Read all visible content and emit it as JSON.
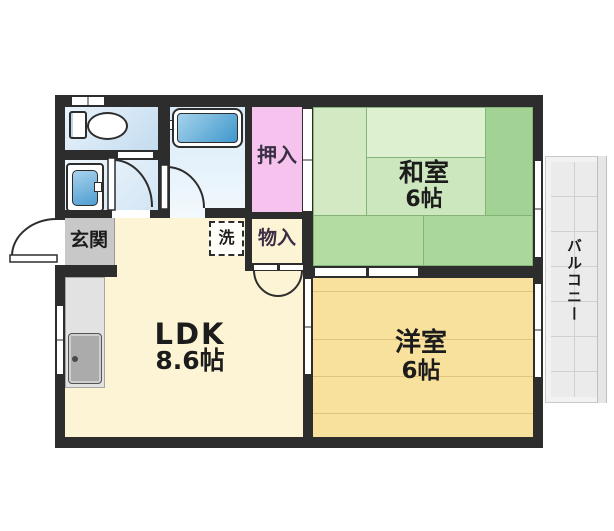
{
  "plan": {
    "title": "2DK apartment floor plan",
    "rooms": {
      "ldk": {
        "name": "LDK",
        "size": "8.6帖"
      },
      "washitsu": {
        "name": "和室",
        "size": "6帖"
      },
      "yoshitsu": {
        "name": "洋室",
        "size": "6帖"
      },
      "genkan": {
        "label": "玄関"
      },
      "oshiire": {
        "label": "押入"
      },
      "monoire": {
        "label": "物入"
      },
      "laundry": {
        "label": "洗"
      },
      "balcony": {
        "label": "バルコニー"
      }
    },
    "colors": {
      "wall": "#2d2d2d",
      "tatami_green": "#c9e6ba",
      "wood_yellow": "#f7e19c",
      "ldk_cream": "#fcf4d4",
      "closet_pink": "#f5c3ee",
      "water_blue": "#d6eaf8",
      "bathtub_blue": "#3e97cc",
      "genkan_gray": "#c8c8c8",
      "balcony_gray": "#ebebeb"
    }
  }
}
